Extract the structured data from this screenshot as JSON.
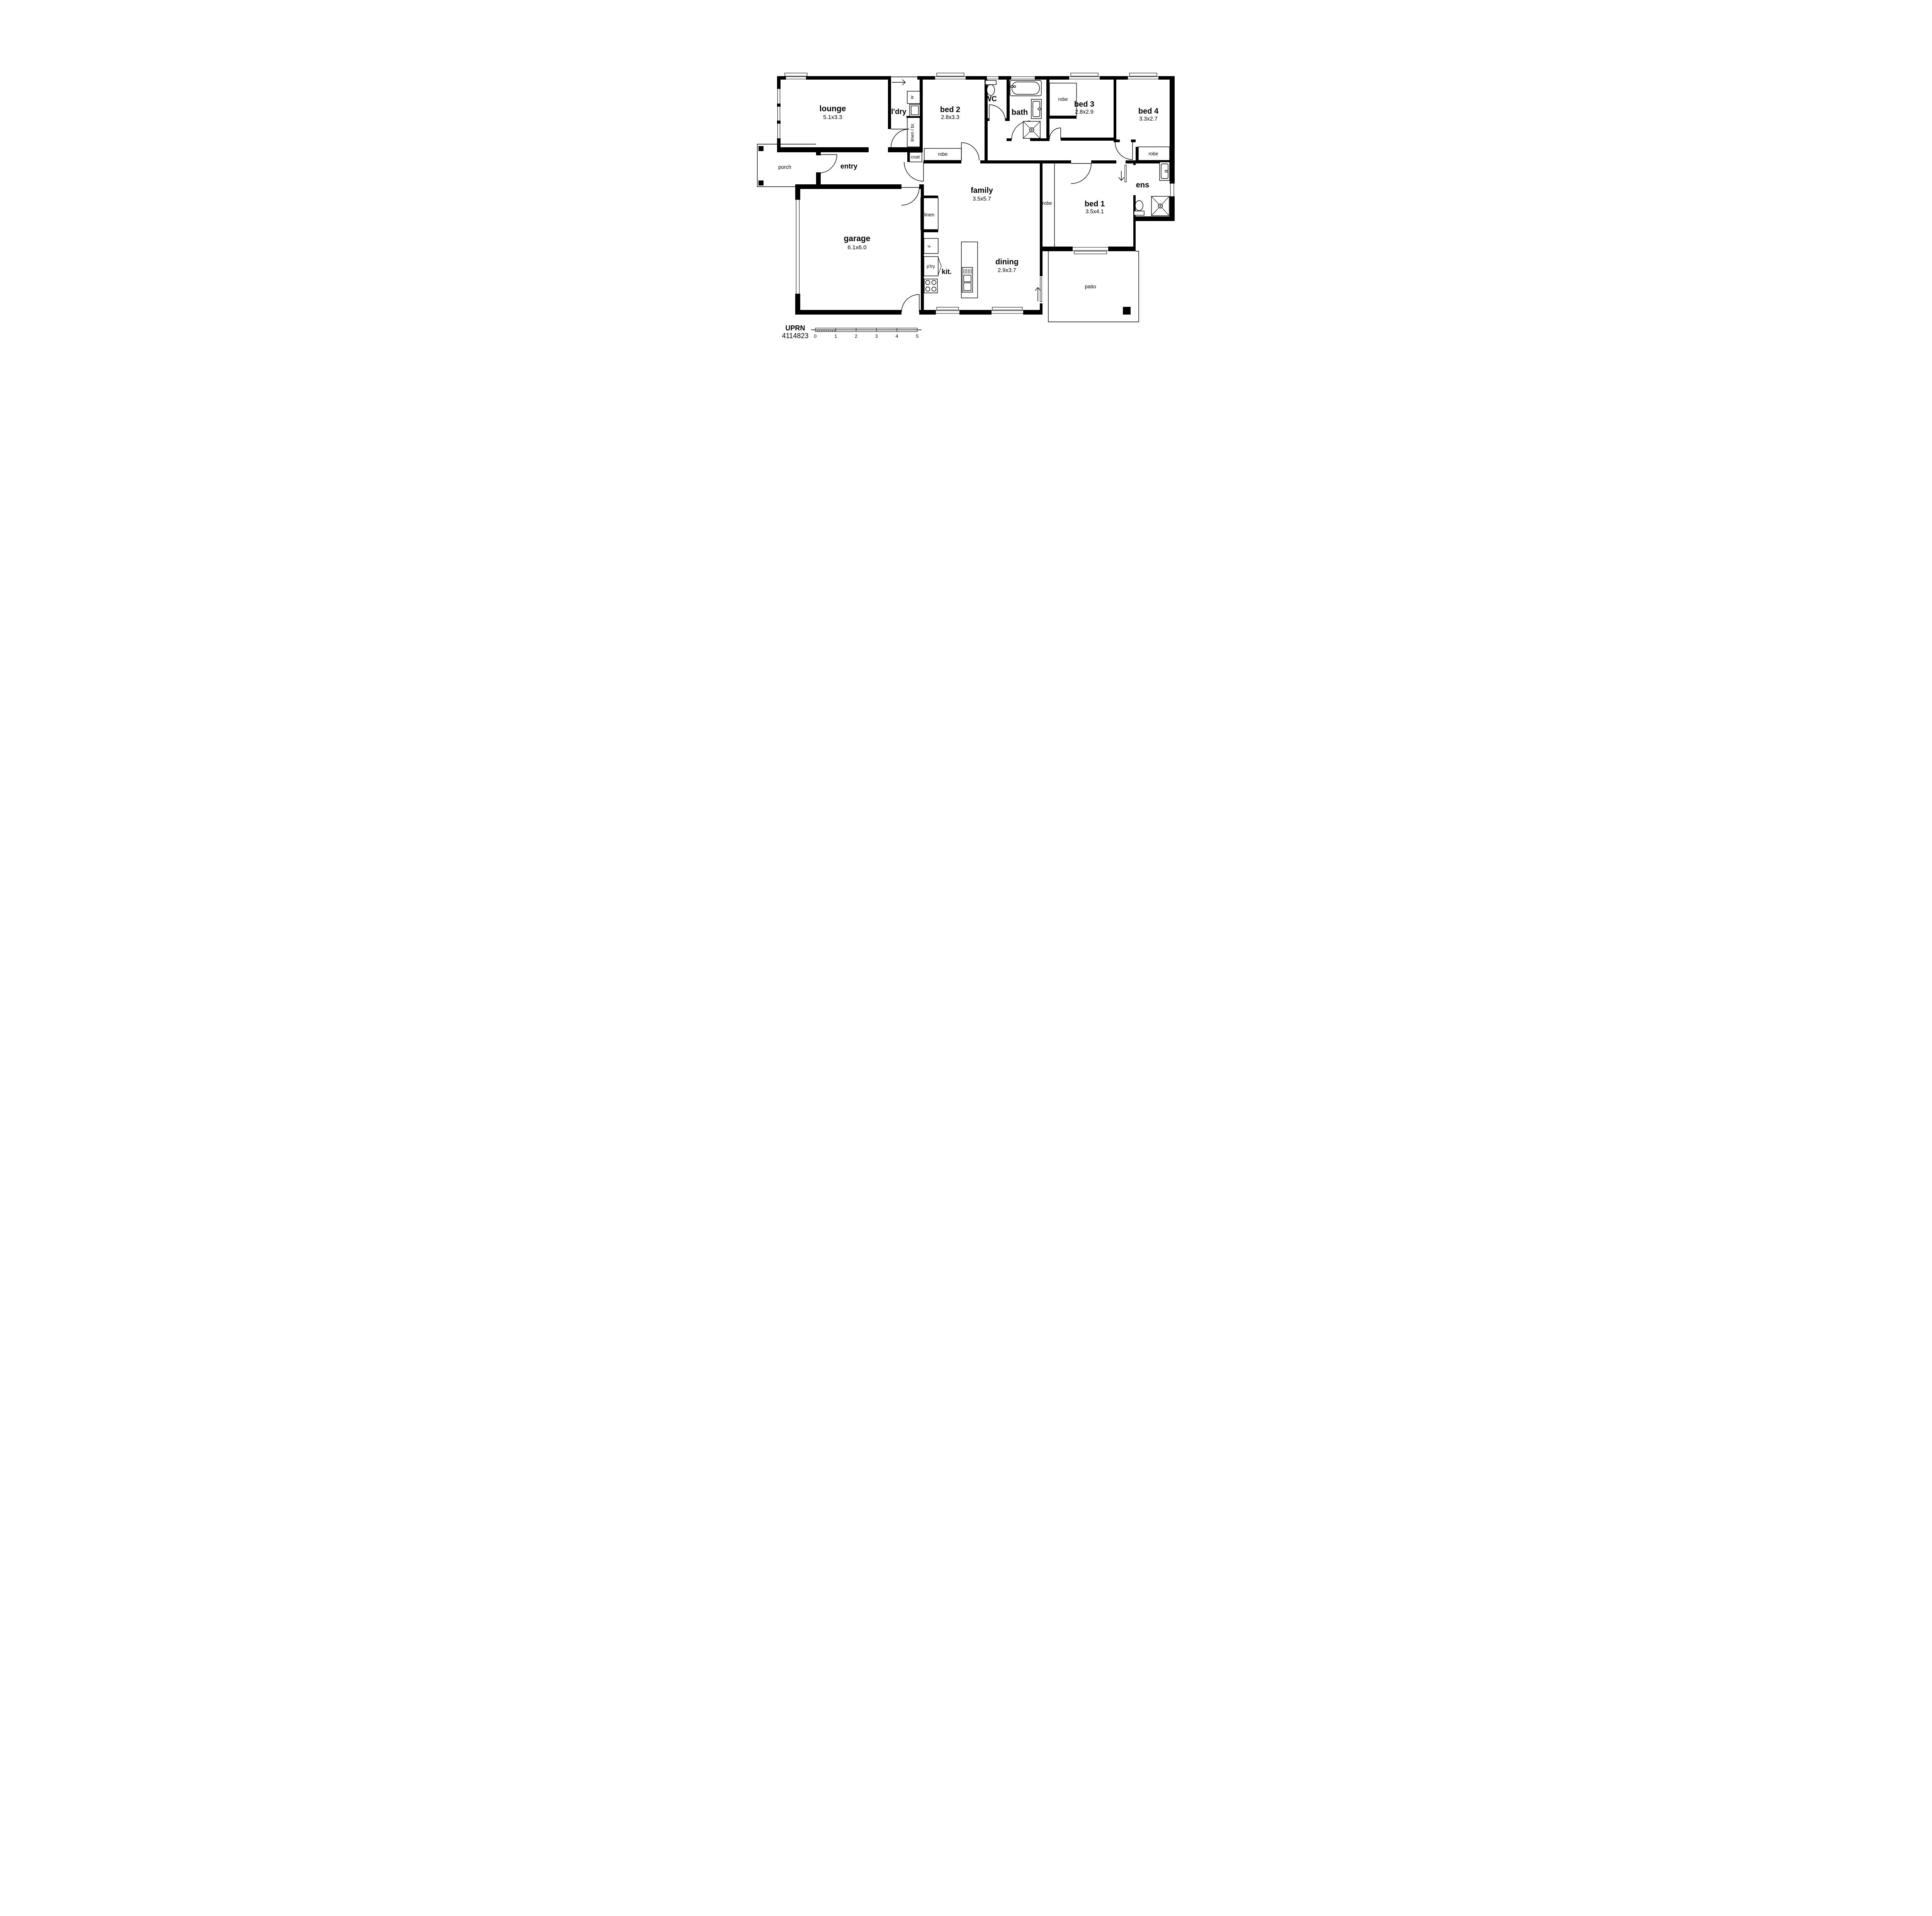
{
  "branding": {
    "uprn_label": "UPRN",
    "uprn_value": "4114823"
  },
  "scale_bar": {
    "ticks": [
      "0",
      "1",
      "2",
      "3",
      "4",
      "5"
    ]
  },
  "rooms": {
    "lounge": {
      "label": "lounge",
      "dim": "5.1x3.3"
    },
    "laundry": {
      "label": "l'dry"
    },
    "bed2": {
      "label": "bed 2",
      "dim": "2.8x3.3"
    },
    "wc": {
      "label": "WC"
    },
    "bath": {
      "label": "bath"
    },
    "bed3": {
      "label": "bed 3",
      "dim": "2.8x2.9"
    },
    "bed4": {
      "label": "bed 4",
      "dim": "3.3x2.7"
    },
    "porch": {
      "label": "porch"
    },
    "entry": {
      "label": "entry"
    },
    "family": {
      "label": "family",
      "dim": "3.5x5.7"
    },
    "bed1": {
      "label": "bed 1",
      "dim": "3.5x4.1"
    },
    "ens": {
      "label": "ens"
    },
    "garage": {
      "label": "garage",
      "dim": "6.1x6.0"
    },
    "kitchen": {
      "label": "kit."
    },
    "dining": {
      "label": "dining",
      "dim": "2.9x3.7"
    },
    "patio": {
      "label": "patio"
    }
  },
  "storage": {
    "linen_br": {
      "label": "linen / br."
    },
    "coat": {
      "label": "coat"
    },
    "robe": {
      "label": "robe"
    },
    "linen": {
      "label": "linen"
    },
    "pantry": {
      "label": "p'try"
    }
  },
  "appliances": {
    "washer": {
      "label": "w"
    },
    "fridge": {
      "label": "F"
    }
  },
  "colors": {
    "wall": "#000000",
    "background": "#ffffff"
  }
}
